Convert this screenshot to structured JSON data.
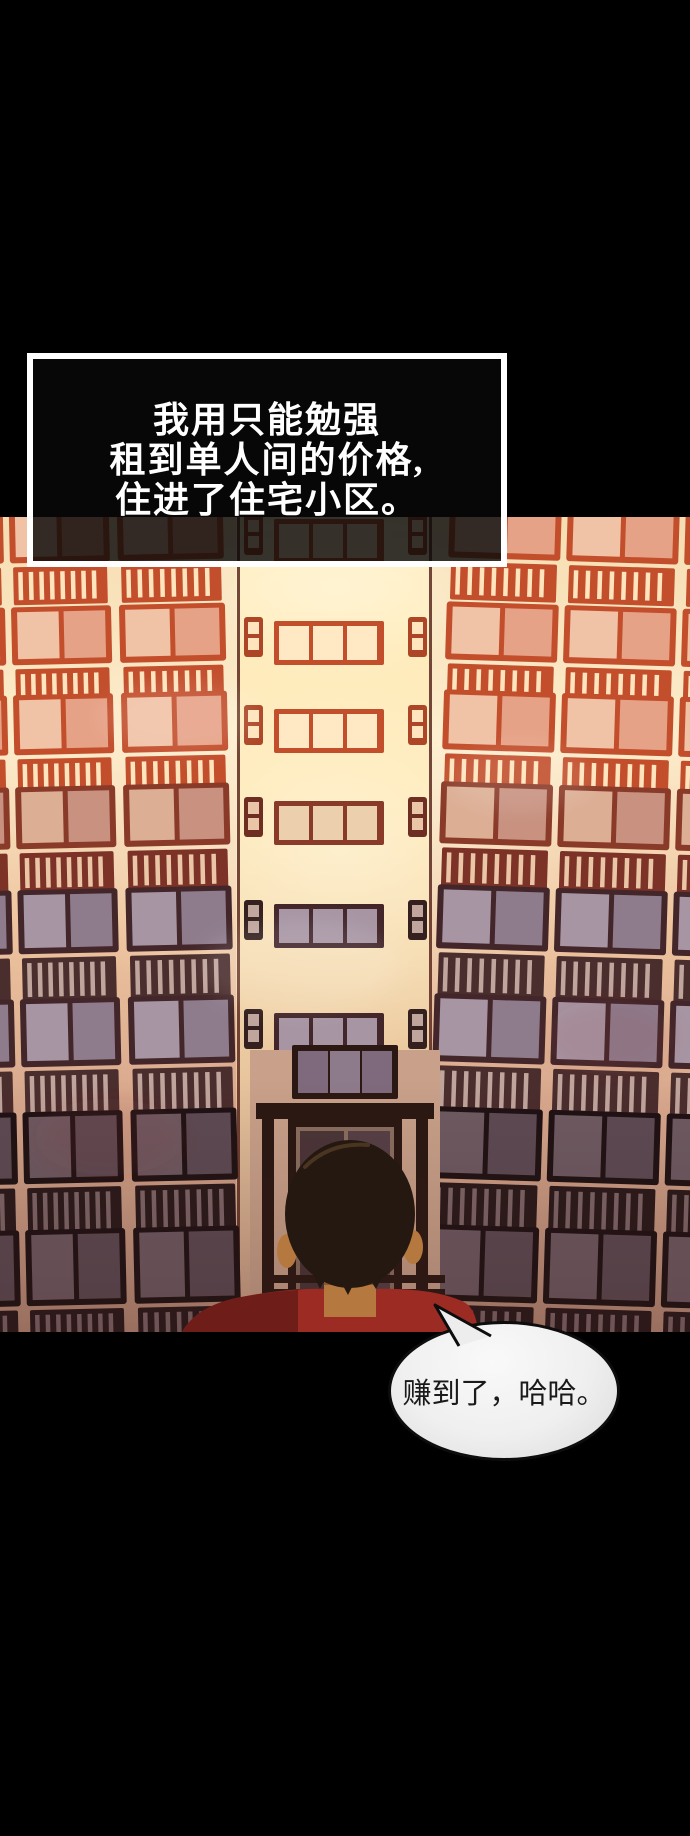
{
  "panel": {
    "background": "#000000"
  },
  "narration": {
    "lines": [
      "我用只能勉强",
      "租到单人间的价格,",
      "住进了住宅小区。"
    ],
    "text_color": "#ffffff",
    "box_border_color": "#ffffff",
    "box_fill": "rgba(8,8,8,0.82)"
  },
  "speech_bubble": {
    "text": "赚到了，哈哈。",
    "fill": "#efefef",
    "border_color": "#0d0d0d",
    "text_color": "#1a1a1a"
  },
  "illustration": {
    "subject": "apartment building facade with rows of balconies seen from a low angle",
    "figure": "man with black hair seen from behind looking up at the building",
    "palette": {
      "bright_frame": "#c24e2c",
      "bright_wall": "#fdeccb",
      "muted_frame": "#42262a",
      "muted_wall": "#d8a88d",
      "dark_frame": "#1f1214",
      "center_glow": "#ffeec0",
      "hair": "#241810",
      "shirt": "#9c2b24",
      "skin": "#b5793f"
    }
  }
}
